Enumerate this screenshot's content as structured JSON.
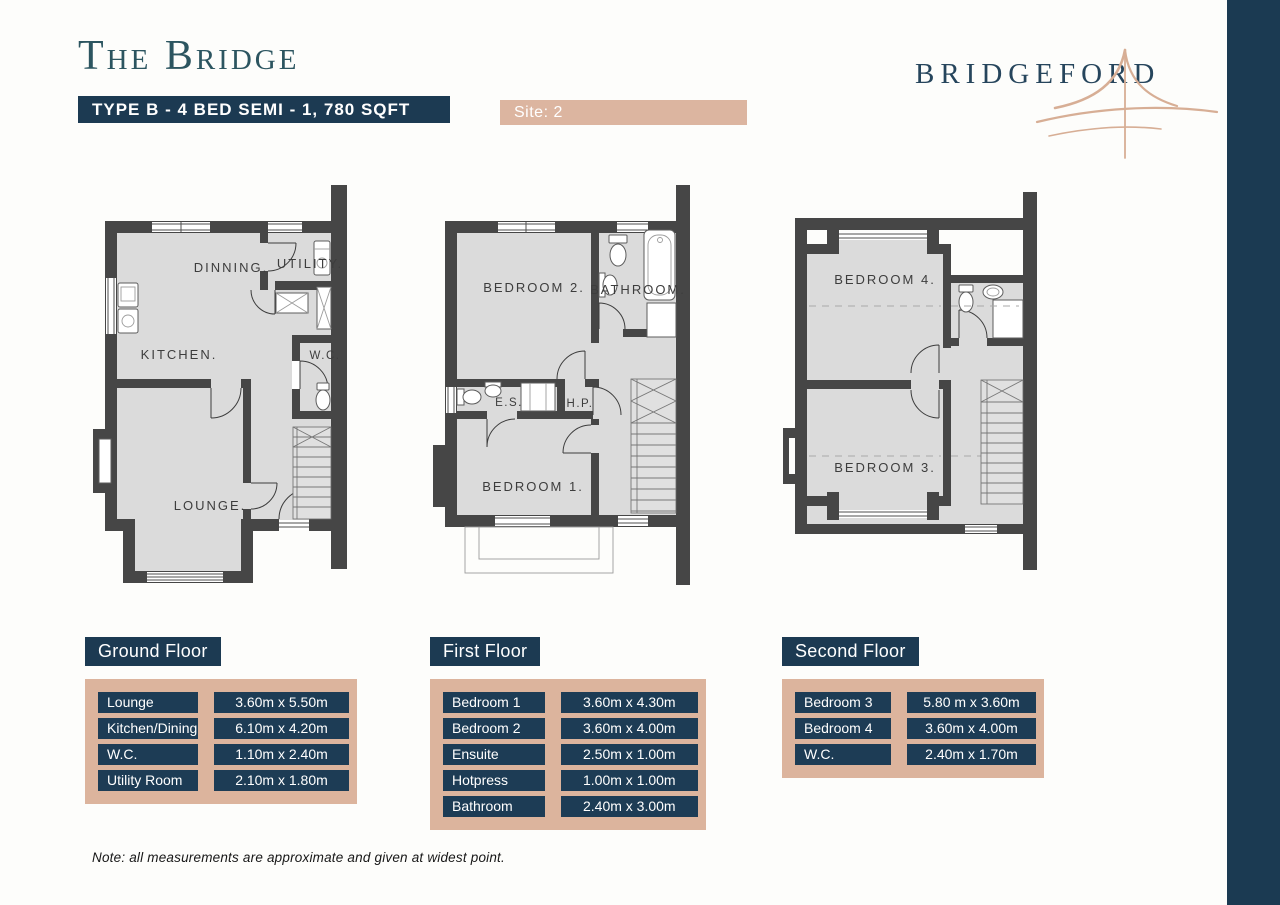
{
  "header": {
    "title": "The Bridge",
    "type_banner": "TYPE B - 4 BED SEMI - 1, 780 SQFT",
    "site_banner": "Site: 2",
    "brand": "BRIDGEFORD"
  },
  "plans": {
    "ground": {
      "dining": "DINNING.",
      "utility": "UTILITY.",
      "kitchen": "KITCHEN.",
      "wc": "W.C.",
      "lounge": "LOUNGE."
    },
    "first": {
      "bedroom2": "BEDROOM 2.",
      "bathroom": "BATHROOM.",
      "ensuite": "E.S.",
      "hotpress": "H.P.",
      "bedroom1": "BEDROOM 1."
    },
    "second": {
      "bedroom4": "BEDROOM 4.",
      "bedroom3": "BEDROOM 3."
    }
  },
  "tables": [
    {
      "name": "Ground Floor",
      "rooms": [
        {
          "label": "Lounge",
          "size": "3.60m x 5.50m"
        },
        {
          "label": "Kitchen/Dining",
          "size": "6.10m x 4.20m"
        },
        {
          "label": "W.C.",
          "size": "1.10m x 2.40m"
        },
        {
          "label": "Utility Room",
          "size": "2.10m x 1.80m"
        }
      ]
    },
    {
      "name": "First Floor",
      "rooms": [
        {
          "label": "Bedroom 1",
          "size": "3.60m x 4.30m"
        },
        {
          "label": "Bedroom 2",
          "size": "3.60m x 4.00m"
        },
        {
          "label": "Ensuite",
          "size": "2.50m x 1.00m"
        },
        {
          "label": "Hotpress",
          "size": "1.00m x 1.00m"
        },
        {
          "label": "Bathroom",
          "size": "2.40m x 3.00m"
        }
      ]
    },
    {
      "name": "Second Floor",
      "rooms": [
        {
          "label": "Bedroom 3",
          "size": "5.80 m x 3.60m"
        },
        {
          "label": "Bedroom 4",
          "size": "3.60m x 4.00m"
        },
        {
          "label": "W.C.",
          "size": "2.40m x 1.70m"
        }
      ]
    }
  ],
  "note": "Note: all measurements are approximate and given at widest point.",
  "colors": {
    "navy": "#1c3a52",
    "tan": "#dcb49d",
    "teal": "#2c5560",
    "swoosh": "#d7ae95"
  }
}
